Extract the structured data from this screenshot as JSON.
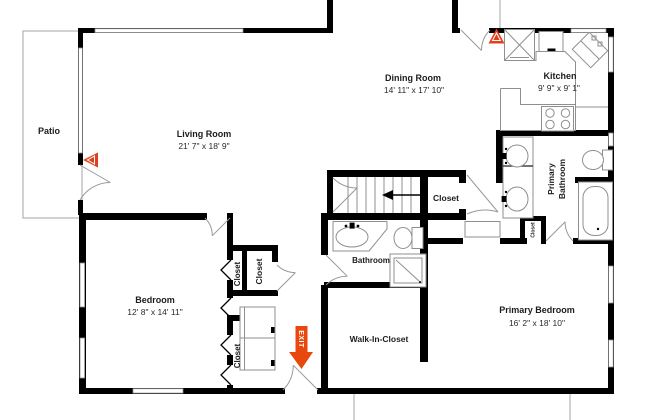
{
  "floorplan": {
    "title": "Floor plan",
    "colors": {
      "wall": "#000000",
      "thin_line": "#8f8f8f",
      "light_line": "#b3b3b3",
      "camera_marker_red": "#e2401c",
      "exit_orange": "#e8470e",
      "background": "#ffffff"
    },
    "rooms": {
      "patio": {
        "name": "Patio"
      },
      "living_room": {
        "name": "Living Room",
        "dims": "21' 7\" x 18' 9\""
      },
      "dining_room": {
        "name": "Dining Room",
        "dims": "14' 11\" x 17' 10\""
      },
      "kitchen": {
        "name": "Kitchen",
        "dims": "9' 9\" x 9' 1\""
      },
      "bedroom": {
        "name": "Bedroom",
        "dims": "12' 8\" x 14' 11\""
      },
      "primary_bedroom": {
        "name": "Primary Bedroom",
        "dims": "16' 2\" x 18' 10\""
      },
      "primary_bathroom": {
        "name_line1": "Primary",
        "name_line2": "Bathroom"
      },
      "bathroom": {
        "name": "Bathroom"
      },
      "walk_in_closet": {
        "name": "Walk-In-Closet"
      },
      "hall_closet": {
        "name": "Closet"
      },
      "bedroom_closet_narrow": {
        "name": "Closet"
      },
      "bedroom_closet_large": {
        "name": "Closet"
      },
      "bedroom_closet_lower": {
        "name": "Closet"
      },
      "bath_closet": {
        "name": "Closet"
      }
    },
    "markers": {
      "exit": {
        "label": "EXIT"
      }
    }
  }
}
